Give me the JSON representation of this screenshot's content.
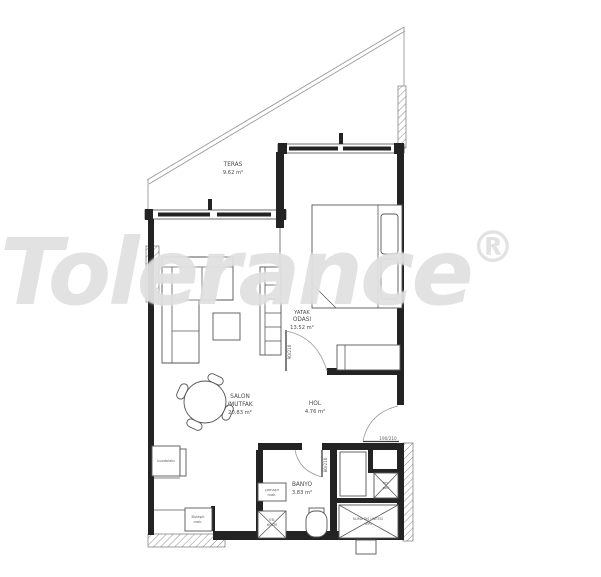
{
  "watermark": {
    "brand": "Tolerance",
    "registered_mark": "®"
  },
  "plan": {
    "rooms": {
      "teras": {
        "name": "TERAS",
        "area": "9.62 m²"
      },
      "yatak_odasi": {
        "name_line1": "YATAK",
        "name_line2": "ODASI",
        "area": "13.52 m²"
      },
      "salon_mutfak": {
        "name_line1": "SALON",
        "name_line2": "/MUTFAK",
        "area": "20.83 m²"
      },
      "hol": {
        "name": "HOL",
        "area": "4.76 m²"
      },
      "banyo": {
        "name": "BANYO",
        "area": "3.83 m²"
      }
    },
    "door_sizes": {
      "bedroom_door": "90/210",
      "bathroom_door": "80/210",
      "entrance_door": "190/210"
    },
    "fixtures": {
      "fridge": "buzdolabı",
      "dishwasher_line1": "Bulaşık",
      "dishwasher_line2": "mak.",
      "washer_line1": "çamaşır",
      "washer_line2": "mak.",
      "sink_line1": "Y.B.",
      "sink_line2": "60CM",
      "shaft_line1": "tes.",
      "shaft_line2": "şaftı",
      "ac_line1": "KLİMA DIŞ ÜNİTESİ",
      "ac_line2": "YERİ"
    },
    "colors": {
      "wall": "#232323",
      "line": "#555555",
      "label": "#4a4a4a",
      "watermark": "#cbcbcb"
    }
  }
}
